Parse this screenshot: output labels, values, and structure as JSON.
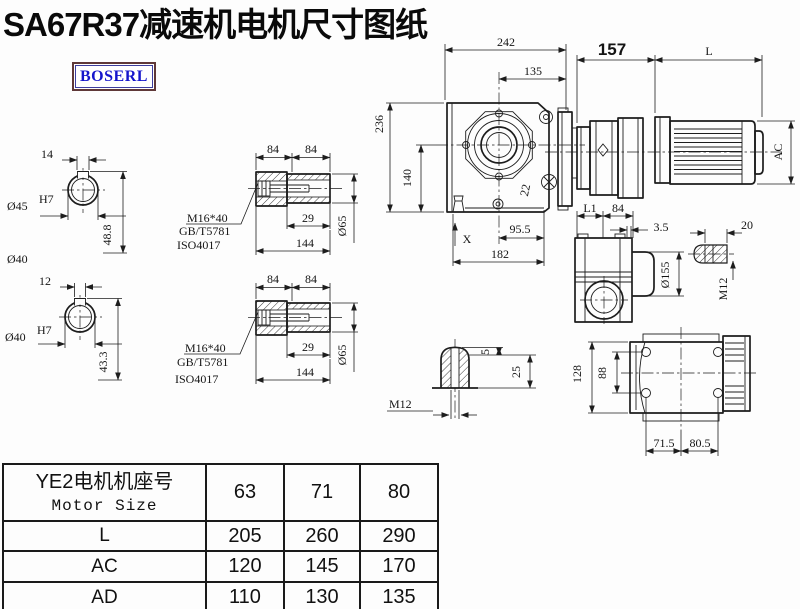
{
  "title": "SA67R37减速机电机尺寸图纸",
  "logo": "BOSERL",
  "drawing": {
    "shaft_upper": {
      "key_width": "14",
      "bore": "Ø45",
      "tol": "H7",
      "depth": "48.8",
      "outer": "Ø40"
    },
    "shaft_lower": {
      "key_width": "12",
      "bore": "Ø40",
      "tol": "H7",
      "depth": "43.3"
    },
    "bushing_upper": {
      "len_a": "84",
      "len_b": "84",
      "bolt": "M16*40",
      "std1": "GB/T5781",
      "std2": "ISO4017",
      "thread_len": "29",
      "total_len": "144",
      "dia": "Ø65"
    },
    "bushing_lower": {
      "len_a": "84",
      "len_b": "84",
      "bolt": "M16*40",
      "std1": "GB/T5781",
      "std2": "ISO4017",
      "thread_len": "29",
      "total_len": "144",
      "dia": "Ø65"
    },
    "front_view": {
      "overall_width": "242",
      "center_to_face": "135",
      "adapter_len": "157",
      "motor_len": "L",
      "overall_height": "236",
      "center_height": "140",
      "foot_height": "22",
      "center_to_edge": "95.5",
      "base_width": "182",
      "position_mark": "X",
      "motor_dia": "AC"
    },
    "side_view": {
      "len_l1": "L1",
      "len_84": "84",
      "step": "3.5",
      "flange_dia": "Ø155",
      "hub_len": "20",
      "tap": "M12"
    },
    "plug_detail": {
      "tip": "5",
      "depth": "25",
      "tap": "M12"
    },
    "top_view": {
      "flange_width": "128",
      "bolt_span": "88",
      "pitch_left": "71.5",
      "pitch_right": "80.5"
    }
  },
  "table": {
    "header_cn": "YE2电机机座号",
    "header_en": "Motor Size",
    "sizes": [
      "63",
      "71",
      "80"
    ],
    "rows": [
      {
        "label": "L",
        "values": [
          "205",
          "260",
          "290"
        ]
      },
      {
        "label": "AC",
        "values": [
          "120",
          "145",
          "170"
        ]
      },
      {
        "label": "AD",
        "values": [
          "110",
          "130",
          "135"
        ]
      }
    ]
  }
}
